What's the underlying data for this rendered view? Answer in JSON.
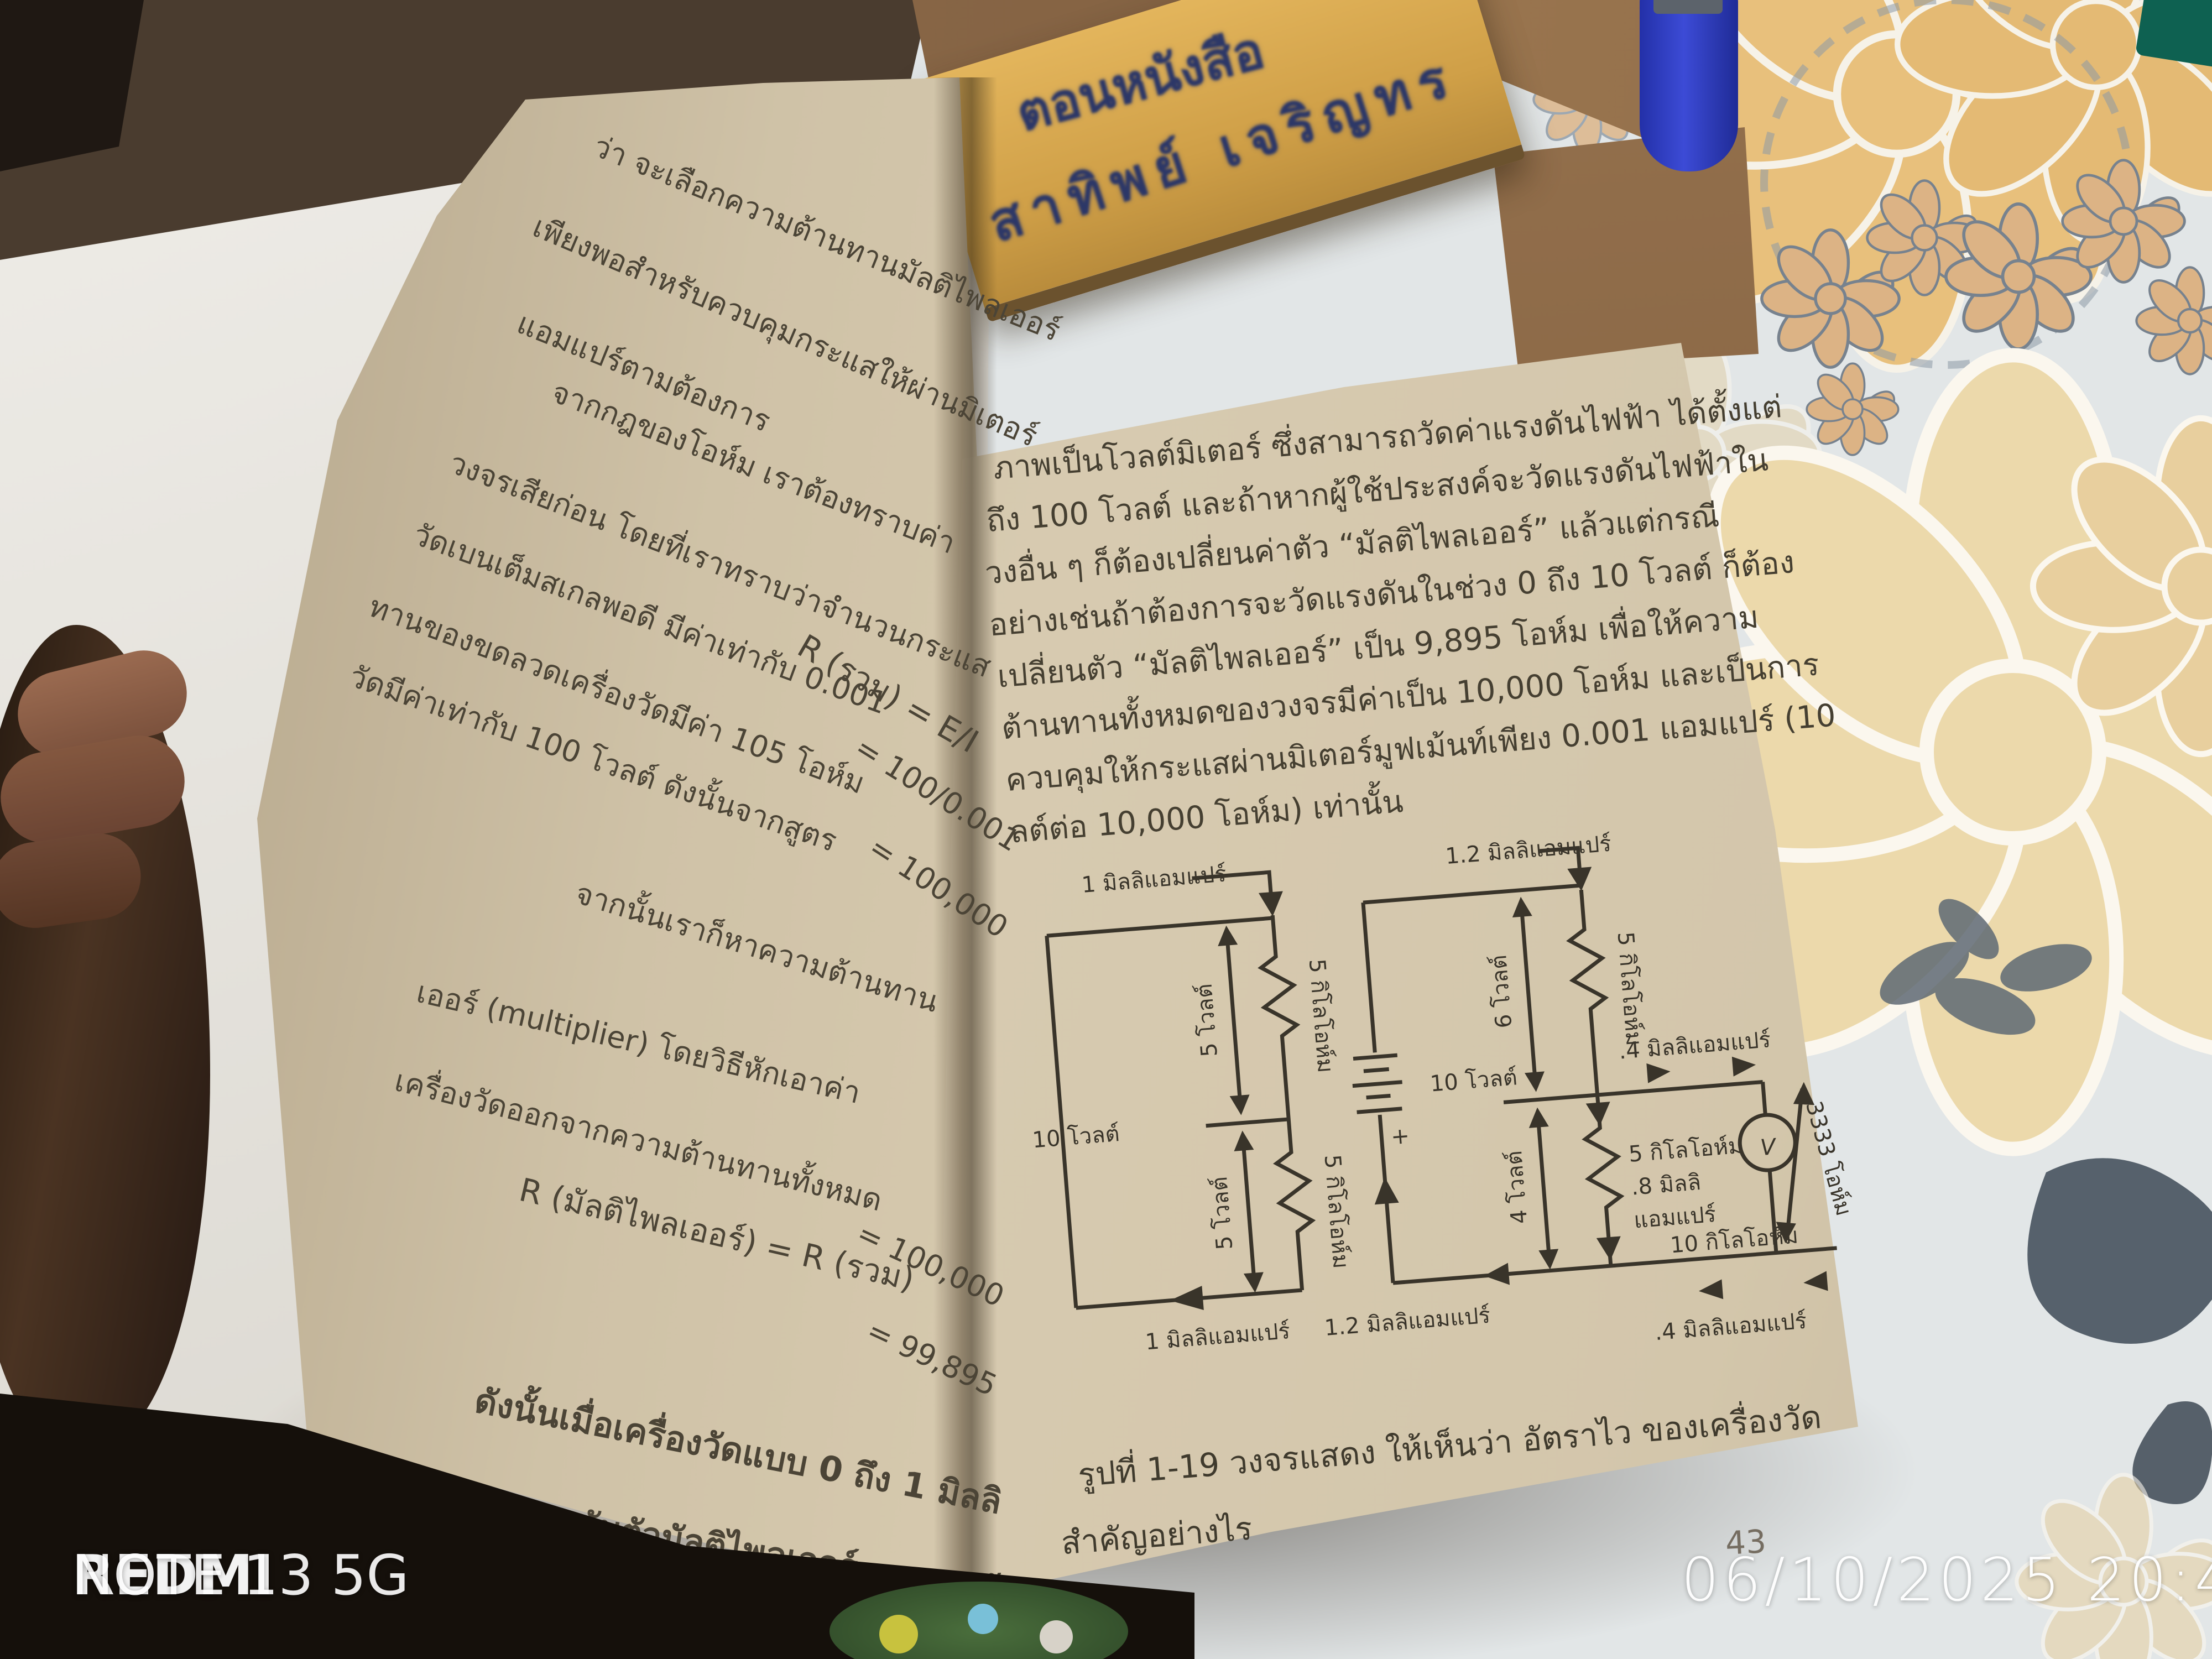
{
  "handwriting": {
    "line1": "ตอนหนังสือ",
    "line2": "สาทิพย์ เจริญทร"
  },
  "left_page": {
    "page_number": "42",
    "lines": [
      "ว่า จะเลือกความต้านทานมัลติไพลเออร์",
      "เพียงพอสำหรับควบคุมกระแสให้ผ่านมิเตอร์",
      "แอมแปร์ตามต้องการ",
      "จากกฎของโอห์ม       เราต้องทราบค่า",
      "วงจรเสียก่อน โดยที่เราทราบว่าจำนวนกระแส",
      "วัดเบนเต็มสเกลพอดี   มีค่าเท่ากับ 0.001",
      "ทานของขดลวดเครื่องวัดมีค่า 105 โอห์ม",
      "วัดมีค่าเท่ากับ 100 โวลต์   ดังนั้นจากสูตร",
      "R (รวม)  =  E/I",
      "=  100/0.001",
      "=  100,000",
      "จากนั้นเราก็หาความต้านทาน",
      "เออร์  (multiplier)  โดยวิธีหักเอาค่า",
      "เครื่องวัดออกจากความต้านทานทั้งหมด",
      "R (มัลติไพลเออร์)  =  R (รวม)",
      "=  100,000",
      "=  99,895",
      "ดังนั้นเมื่อเครื่องวัดแบบ 0 ถึง 1 มิลลิ",
      "มูฟเม้นท์ต่ออนุกรมกับตัวมัลติไพลเออร์"
    ]
  },
  "right_page": {
    "page_number": "43",
    "paragraph": [
      "ภาพเป็นโวลต์มิเตอร์   ซึ่งสามารถวัดค่าแรงดันไฟฟ้า   ได้ตั้งแต่",
      "ถึง 100 โวลต์   และถ้าหากผู้ใช้ประสงค์จะวัดแรงดันไฟฟ้าใน",
      "วงอื่น ๆ   ก็ต้องเปลี่ยนค่าตัว   “มัลติไพลเออร์”   แล้วแต่กรณี",
      "อย่างเช่นถ้าต้องการจะวัดแรงดันในช่วง 0 ถึง 10 โวลต์  ก็ต้อง",
      "เปลี่ยนตัว  “มัลติไพลเออร์”  เป็น 9,895 โอห์ม   เพื่อให้ความ",
      "ต้านทานทั้งหมดของวงจรมีค่าเป็น 10,000 โอห์ม    และเป็นการ",
      "ควบคุมให้กระแสผ่านมิเตอร์มูฟเม้นท์เพียง 0.001 แอมแปร์  (10",
      "ลต์ต่อ 10,000 โอห์ม)  เท่านั้น"
    ],
    "caption_line1": "รูปที่ 1-19   วงจรแสดง ให้เห็นว่า อัตราไว ของเครื่องวัด",
    "caption_line2": "สำคัญอย่างไร",
    "footer": "ฟ้าพื้นฐาน"
  },
  "diagram": {
    "loop_a": {
      "top_current": "1 มิลลิแอมแปร์",
      "bottom_current": "1 มิลลิแอมแปร์",
      "r1": "5 กิโลโอห์ม",
      "r2": "5 กิโลโอห์ม",
      "v1": "5 โวลต์",
      "v2": "5 โวลต์",
      "total_volt": "10 โวลต์"
    },
    "battery": {
      "label": "10 โวลต์",
      "plus": "+"
    },
    "loop_b": {
      "top_current": "1.2 มิลลิแอมแปร์",
      "bottom_current": "1.2 มิลลิแอมแปร์",
      "branch_current": ".4 มิลลิแอมแปร์",
      "bottom_branch_current": ".4 มิลลิแอมแปร์",
      "r1": "5 กิโลโอห์ม",
      "v1": "6 โวลต์",
      "v2": "4 โวลต์",
      "r2_line1": "5 กิโลโอห์ม",
      "r2_line2": ".8 มิลลิ",
      "r2_line3": "แอมแปร์",
      "meter": "V",
      "meter_r": "10 กิโลโอห์ม",
      "series_r": "3333 โอห์ม"
    }
  },
  "watermark": {
    "brand": "REDMI",
    "model": " NOTE 13 5G",
    "timestamp": "06/10/2025 20:44"
  }
}
